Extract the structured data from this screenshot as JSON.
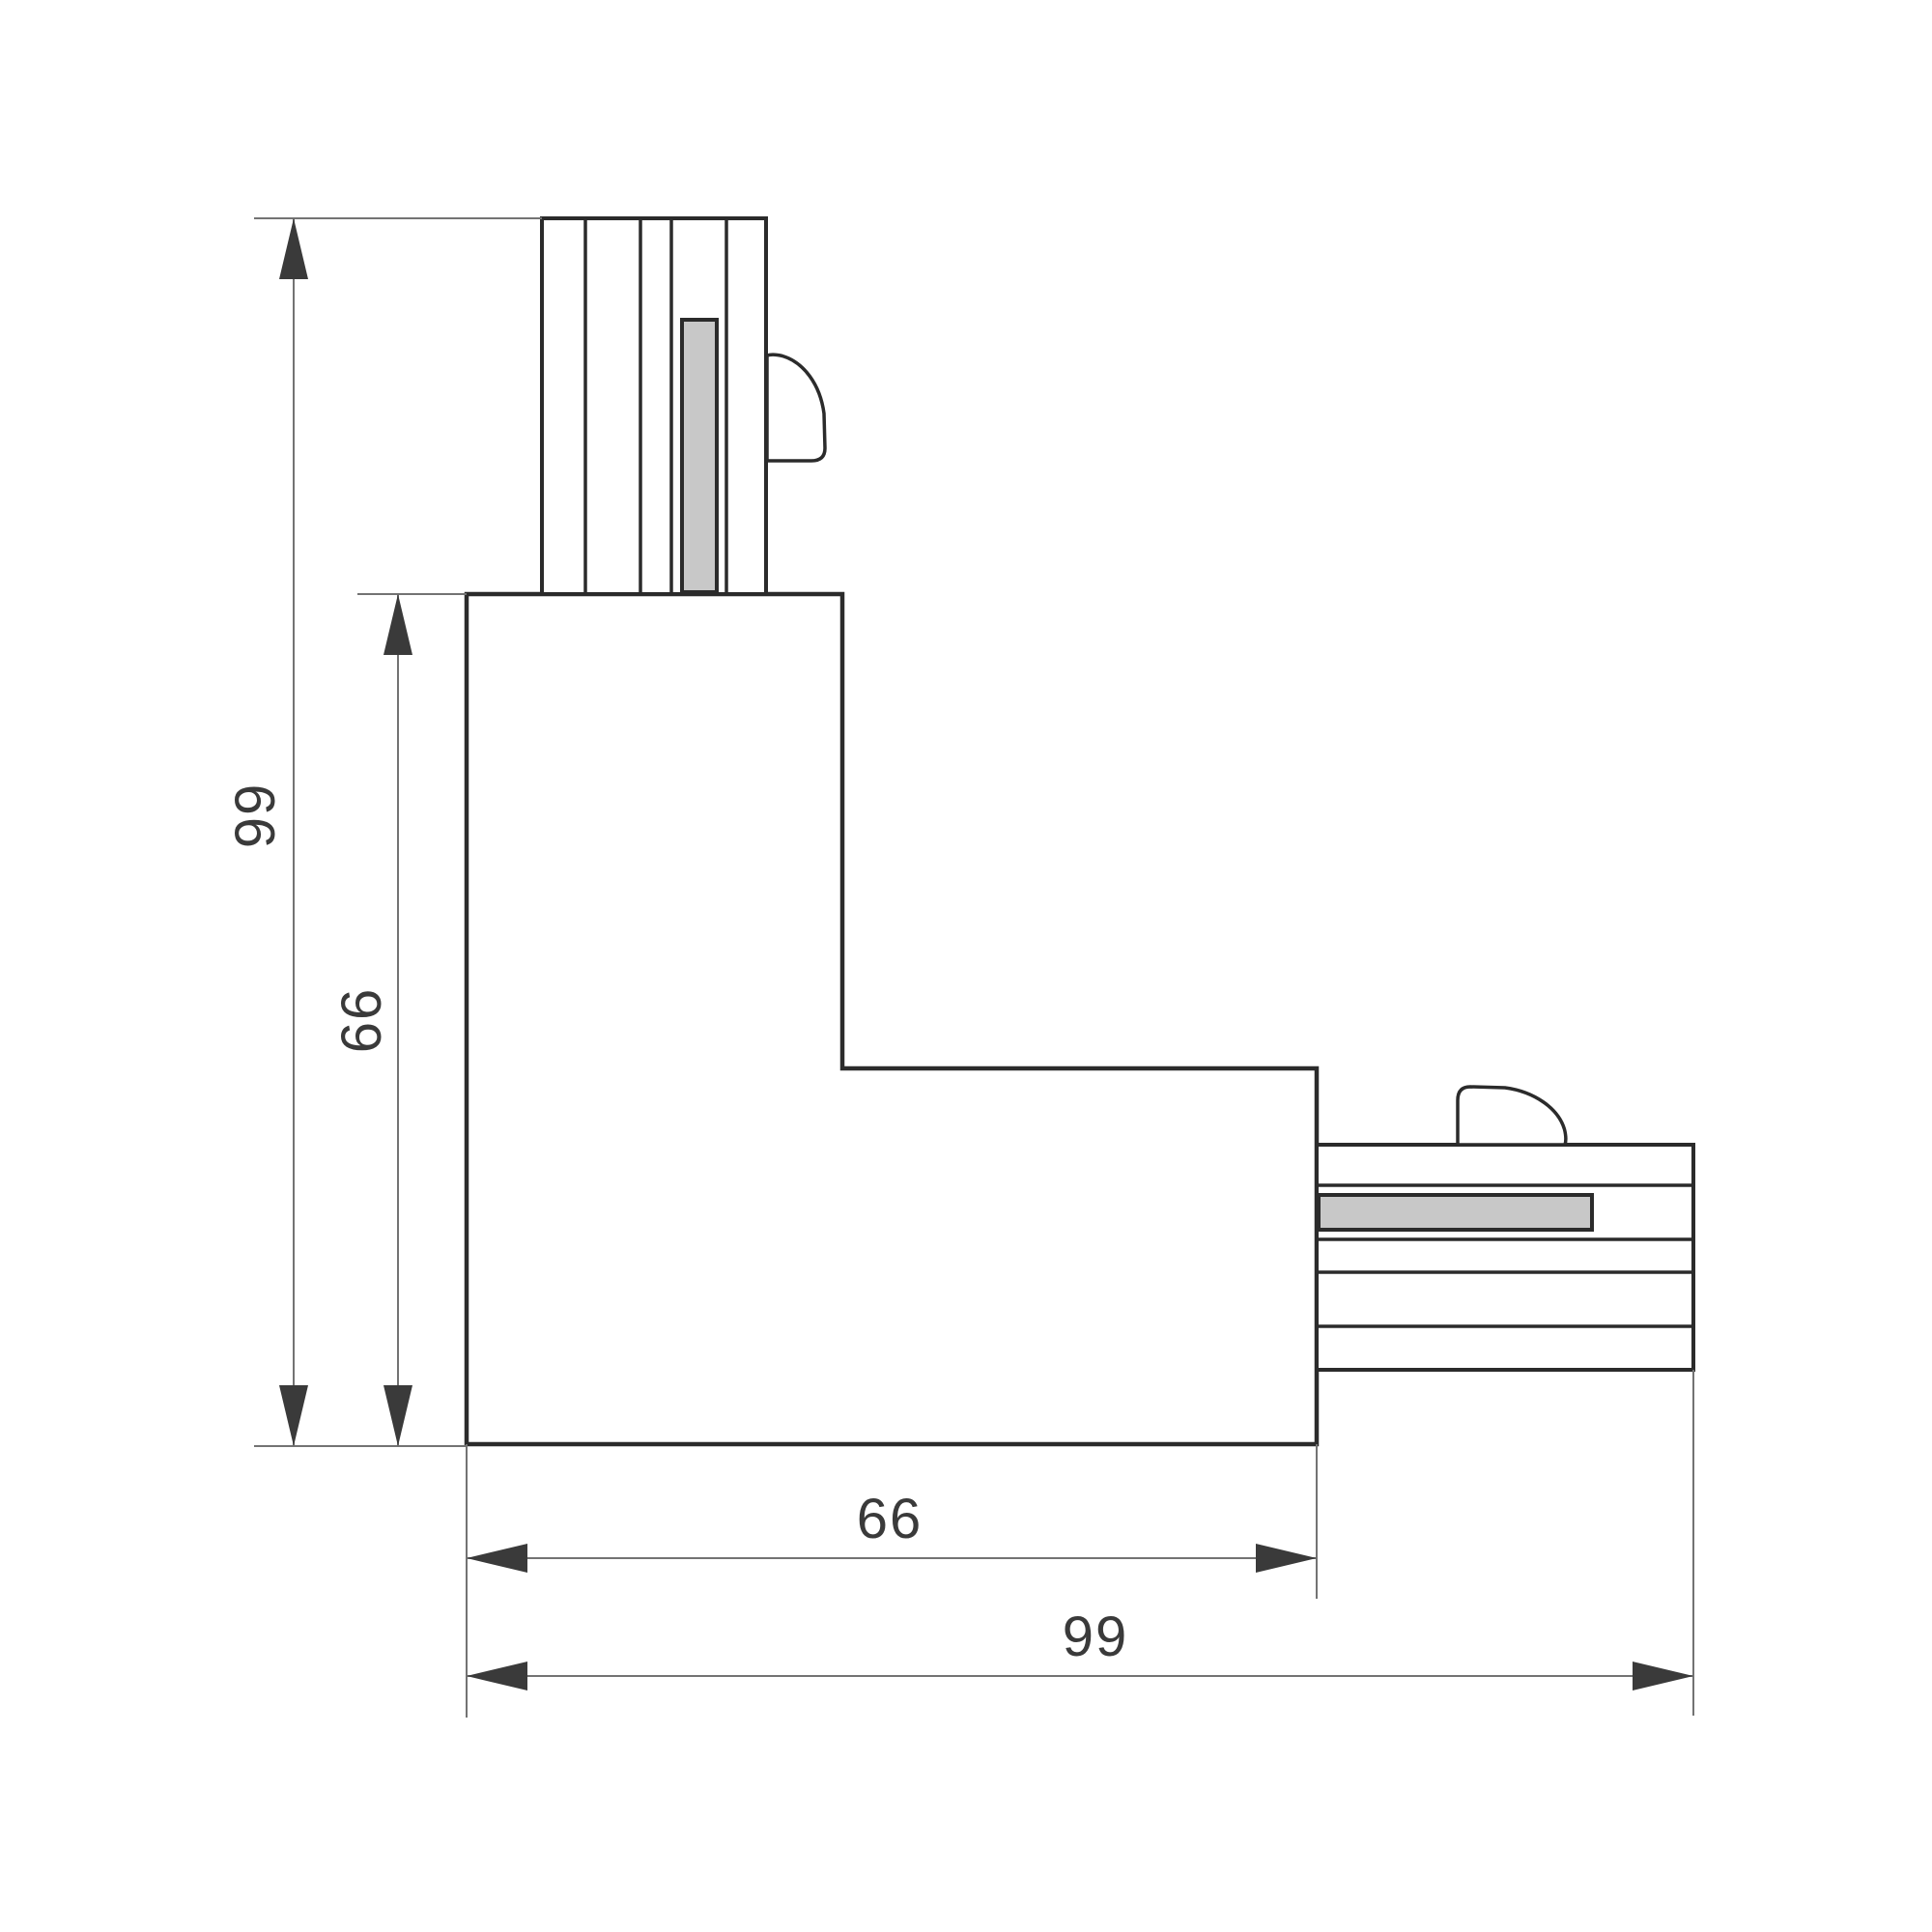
{
  "drawing": {
    "type": "technical-dimension-drawing",
    "colors": {
      "background": "#ffffff",
      "outline": "#2b2b2b",
      "dimension_lines": "#737373",
      "arrowheads": "#3a3a3a",
      "conductor_fill": "#c8c8c8",
      "label_text": "#3a3a3a"
    },
    "dimensions": {
      "vertical_outer": {
        "label": "99"
      },
      "vertical_inner": {
        "label": "66"
      },
      "horizontal_inner": {
        "label": "66"
      },
      "horizontal_outer": {
        "label": "99"
      }
    }
  }
}
